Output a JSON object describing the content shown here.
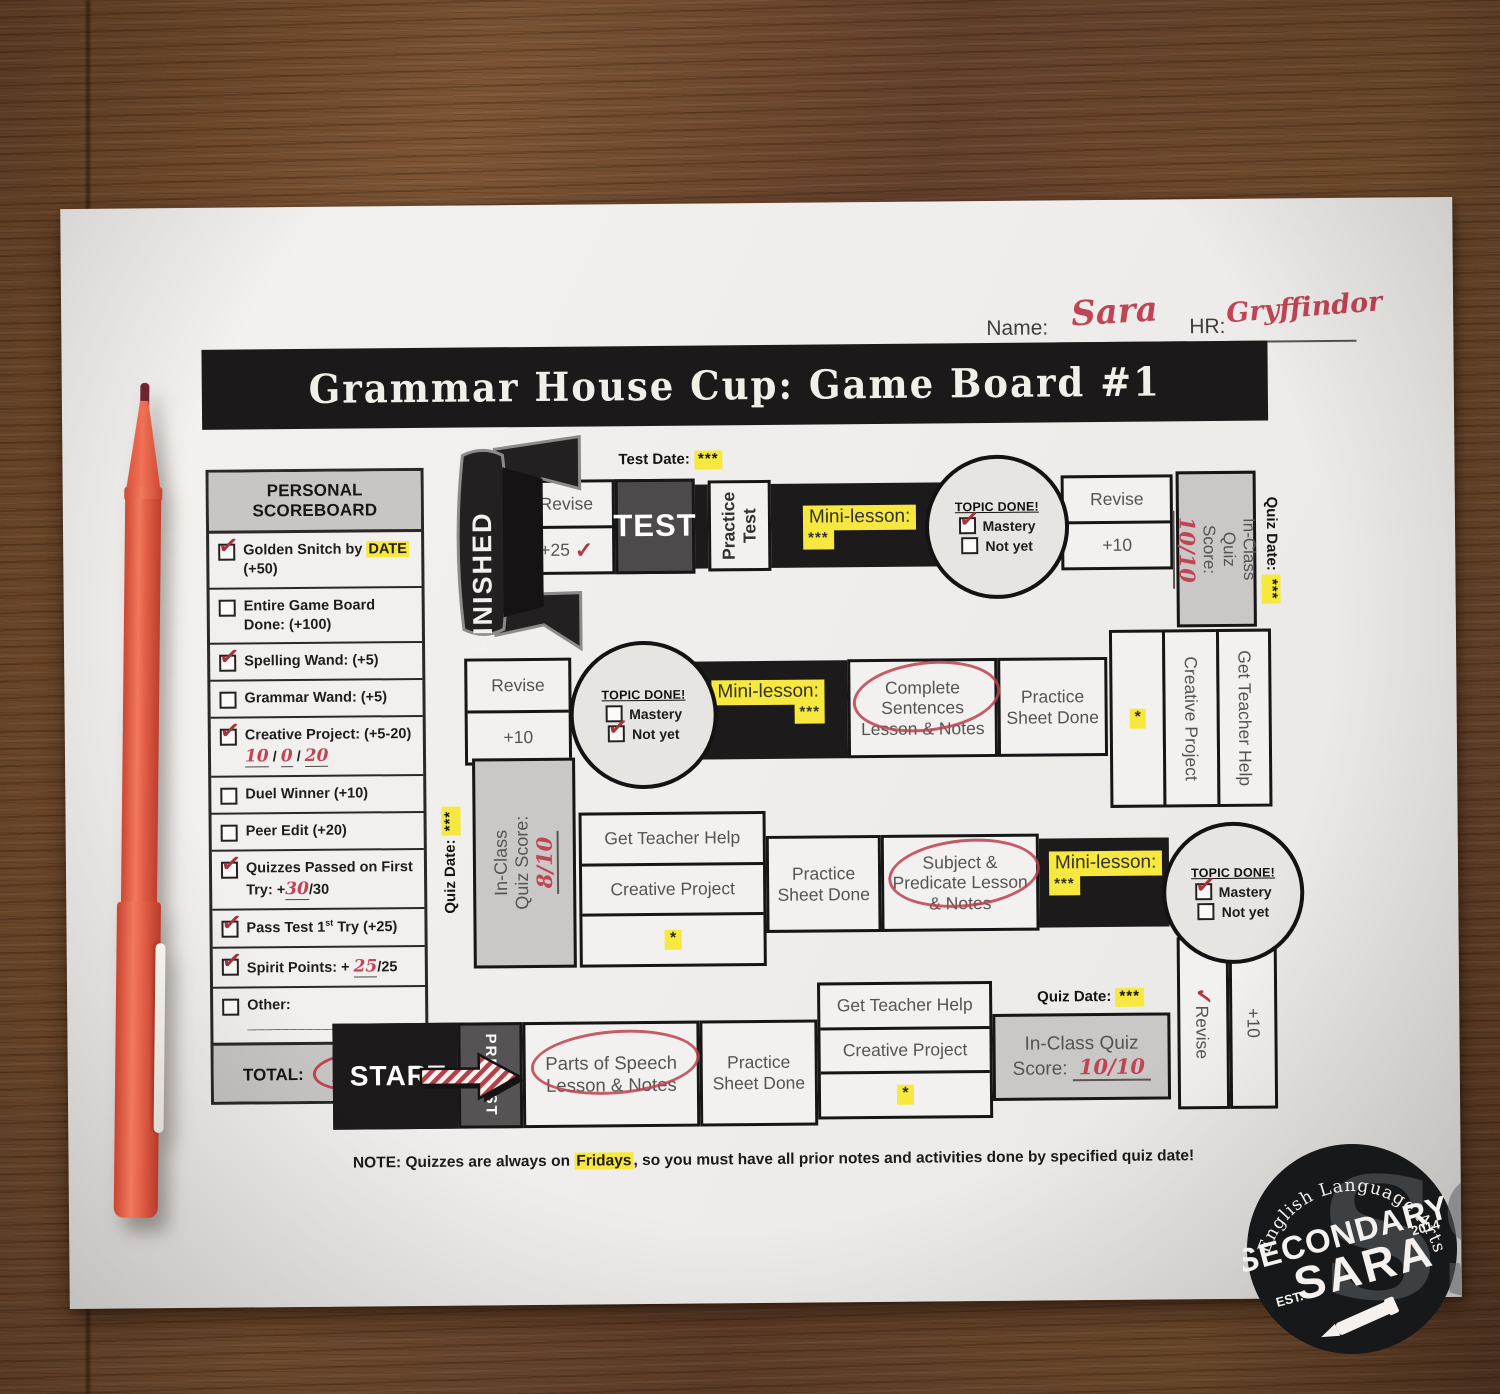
{
  "header": {
    "name_label": "Name:",
    "name_value": "Sara",
    "hr_label": "HR:",
    "hr_value": "Gryffindor"
  },
  "title": "Grammar House Cup: Game Board #1",
  "scoreboard": {
    "title": "PERSONAL SCOREBOARD",
    "items": [
      {
        "checked": true,
        "segments": [
          {
            "t": "Golden Snitch",
            "b": 1
          },
          {
            "t": " by "
          },
          {
            "t": "DATE",
            "hl": 1
          },
          {
            "t": " (+50)"
          }
        ]
      },
      {
        "checked": false,
        "segments": [
          {
            "t": "Entire Game Board Done:",
            "b": 1
          },
          {
            "t": " (+100)"
          }
        ]
      },
      {
        "checked": true,
        "segments": [
          {
            "t": "Spelling Wand:",
            "b": 1
          },
          {
            "t": " (+5)"
          }
        ]
      },
      {
        "checked": false,
        "segments": [
          {
            "t": "Grammar Wand:",
            "b": 1
          },
          {
            "t": " (+5)"
          }
        ]
      },
      {
        "checked": true,
        "segments": [
          {
            "t": "Creative Project:",
            "b": 1
          },
          {
            "t": " (+5-20)  "
          },
          {
            "t": "10",
            "red": 1,
            "u": 1
          },
          {
            "t": " / "
          },
          {
            "t": "0",
            "red": 1,
            "u": 1
          },
          {
            "t": " / "
          },
          {
            "t": "20",
            "red": 1,
            "u": 1
          }
        ]
      },
      {
        "checked": false,
        "segments": [
          {
            "t": "Duel",
            "b": 1
          },
          {
            "t": " Winner (+10)"
          }
        ]
      },
      {
        "checked": false,
        "segments": [
          {
            "t": "Peer "
          },
          {
            "t": "Edit",
            "b": 1
          },
          {
            "t": " (+20)"
          }
        ]
      },
      {
        "checked": true,
        "segments": [
          {
            "t": "Quizzes Passed",
            "b": 1
          },
          {
            "t": " on First Try:  +"
          },
          {
            "t": "30",
            "red": 1,
            "u": 1
          },
          {
            "t": "/30"
          }
        ]
      },
      {
        "checked": true,
        "segments": [
          {
            "t": "Pass "
          },
          {
            "t": "Test",
            "b": 1
          },
          {
            "t": " 1"
          },
          {
            "t": "st",
            "sup": 1
          },
          {
            "t": " Try (+25)"
          }
        ]
      },
      {
        "checked": true,
        "segments": [
          {
            "t": "Spirit Points: + "
          },
          {
            "t": "25",
            "red": 1,
            "u": 1
          },
          {
            "t": "/25"
          }
        ]
      },
      {
        "checked": false,
        "segments": [
          {
            "t": "Other: ________________"
          }
        ]
      }
    ],
    "total_label": "TOTAL:",
    "total_value": "165"
  },
  "board": {
    "finished": "FINISHED",
    "start": "START",
    "pretest": "PRETEST",
    "test": "TEST",
    "test_date_label": "Test Date:",
    "quiz_date_label": "Quiz Date:",
    "stars": "***",
    "star": "*",
    "mini_lesson": "Mini-lesson:",
    "revise": "Revise",
    "plus25": "+25",
    "plus10": "+10",
    "check": "✓",
    "practice_test": "Practice Test",
    "practice_sheet": "Practice Sheet Done",
    "get_teacher_help": "Get Teacher Help",
    "creative_project": "Creative Project",
    "quiz_score_label": "In-Class Quiz Score:",
    "quiz_scores": {
      "top_right": "10/10",
      "middle_left": "8/10",
      "bottom": "10/10"
    },
    "lessons": {
      "parts_of_speech": "Parts of Speech Lesson & Notes",
      "subject_predicate": "Subject & Predicate Lesson & Notes",
      "complete_sentences": "Complete Sentences Lesson & Notes"
    },
    "topic_done": {
      "title": "TOPIC DONE!",
      "mastery": "Mastery",
      "not_yet": "Not yet"
    },
    "topic_circles": [
      {
        "position": "top",
        "checked": "mastery"
      },
      {
        "position": "middle",
        "checked": "not_yet"
      },
      {
        "position": "bottom",
        "checked": "mastery"
      }
    ]
  },
  "note": {
    "segments": [
      {
        "t": "NOTE:",
        "b": 1
      },
      {
        "t": " Quizzes are always on "
      },
      {
        "t": "Fridays",
        "hl": 1,
        "b": 1
      },
      {
        "t": ", so you must have all prior notes and activities done by specified quiz date!"
      }
    ]
  },
  "logo": {
    "arc_text": "English Language Arts",
    "word1": "SECONDARY",
    "word2": "SARA",
    "est": "EST.",
    "year": "2014",
    "monogram": "SS"
  }
}
